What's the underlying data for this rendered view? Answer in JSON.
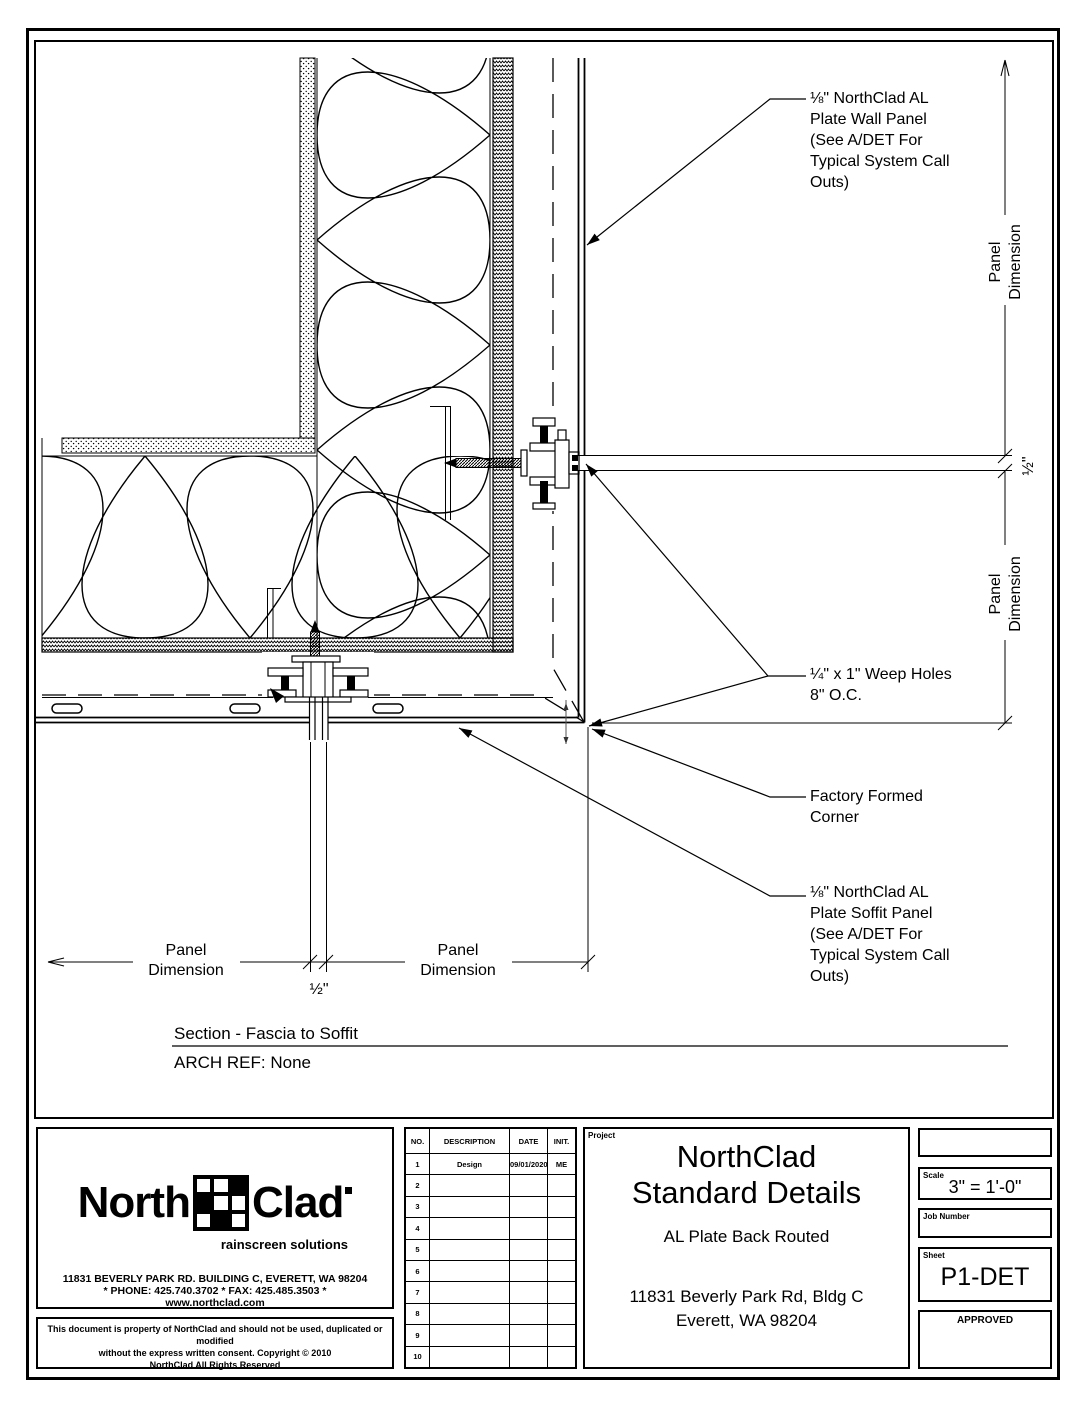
{
  "notes": {
    "wall_panel": "⅛\" NorthClad AL\nPlate Wall Panel\n(See A/DET For\nTypical System Call\nOuts)",
    "weep_holes": "¼\" x 1\" Weep Holes\n8\" O.C.",
    "factory_corner": "Factory Formed\nCorner",
    "soffit_panel": "⅛\" NorthClad AL\nPlate Soffit Panel\n(See A/DET For\nTypical System Call\nOuts)"
  },
  "dims": {
    "panel_dimension": "Panel\nDimension",
    "half_inch": "½\""
  },
  "section": {
    "title": "Section - Fascia to Soffit",
    "arch_ref": "ARCH REF: None"
  },
  "title_block": {
    "logo": {
      "north": "North",
      "clad": "Clad",
      "tagline": "rainscreen solutions",
      "address": "11831 BEVERLY PARK RD. BUILDING C, EVERETT, WA 98204",
      "phone": "* PHONE: 425.740.3702 * FAX: 425.485.3503 *",
      "web": "www.northclad.com"
    },
    "copyright": "This document is property of NorthClad and should not be used, duplicated or modified\nwithout the express written consent.  Copyright  © 2010\nNorthClad All Rights Reserved",
    "revision_table": {
      "headers": [
        "NO.",
        "DESCRIPTION",
        "DATE",
        "INIT."
      ],
      "rows": [
        [
          "1",
          "Design",
          "09/01/2020",
          "ME"
        ],
        [
          "2",
          "",
          "",
          ""
        ],
        [
          "3",
          "",
          "",
          ""
        ],
        [
          "4",
          "",
          "",
          ""
        ],
        [
          "5",
          "",
          "",
          ""
        ],
        [
          "6",
          "",
          "",
          ""
        ],
        [
          "7",
          "",
          "",
          ""
        ],
        [
          "8",
          "",
          "",
          ""
        ],
        [
          "9",
          "",
          "",
          ""
        ],
        [
          "10",
          "",
          "",
          ""
        ]
      ]
    },
    "project": {
      "label": "Project",
      "title_line1": "NorthClad",
      "title_line2": "Standard Details",
      "subtitle": "AL Plate Back Routed",
      "address1": "11831 Beverly Park Rd, Bldg C",
      "address2": "Everett, WA 98204"
    },
    "scale": {
      "label": "Scale",
      "value": "3\" = 1'-0\""
    },
    "job": {
      "label": "Job Number"
    },
    "sheet": {
      "label": "Sheet",
      "value": "P1-DET"
    },
    "approved": {
      "label": "APPROVED"
    }
  },
  "colors": {
    "line": "#000000",
    "paper": "#ffffff"
  }
}
